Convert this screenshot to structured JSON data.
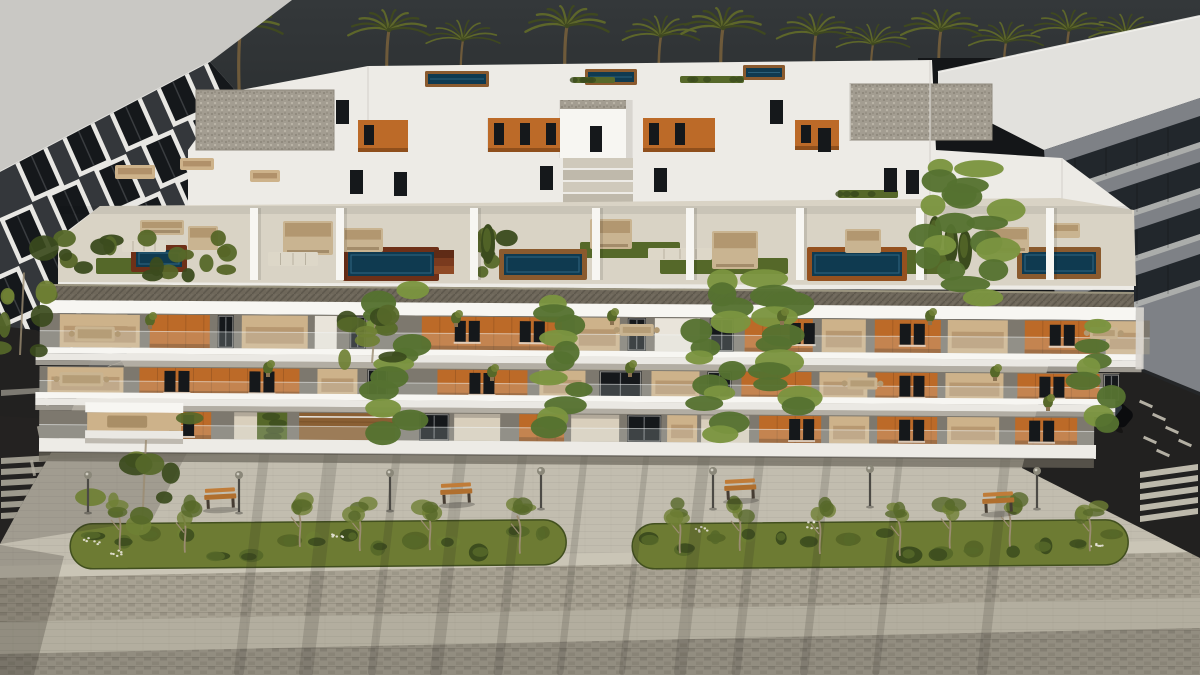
{
  "scene": {
    "label": "aerial-render-of-modern-apartment-complex-with-rooftop-pools-palms-and-promenade"
  },
  "colors": {
    "sky_top": "#34383a",
    "sky_bottom": "#1b1e20",
    "dark_gap": "#141618",
    "palm_frond": "#3f4820",
    "palm_frond_light": "#5d662a",
    "palm_trunk": "#6e5a3a",
    "left_roof": "#c9c8c4",
    "left_facade": "#34373b",
    "window_frame": "#e8e7e3",
    "window_glass": "#15181b",
    "right_roof": "#e2e1dd",
    "right_facade": "#7e8186",
    "right_glass": "#22272c",
    "right_slab": "#b0b1af",
    "white_mass": "#edebe6",
    "white_bright": "#f7f6f2",
    "white_shade": "#d8d5cf",
    "gravel": "#a39d91",
    "gravel_dot": "#8d877b",
    "gravel_light": "#bdb7aa",
    "terrace_floor": "#d9d3c5",
    "terrace_light": "#e6e1d4",
    "parapet": "#6e675a",
    "parapet_dark": "#4e483c",
    "parapet_light": "#9a947f",
    "pool_water": "#0f3a50",
    "pool_water_light": "#2b607a",
    "deck_mahogany": "#6e3018",
    "deck_brown": "#8a5a2e",
    "deck_terracotta": "#95511f",
    "deck_floor": "#8a5f33",
    "turf": "#556829",
    "hedge_dark": "#3b4b1d",
    "hedge_mid": "#566829",
    "hedge_light": "#6f8034",
    "orange_panel": "#bc6a28",
    "orange_dark": "#8f4f1c",
    "interior": "#cdb28a",
    "interior_dark": "#a5835c",
    "curtain": "#e9e4da",
    "entrance": "#d9cfbc",
    "recess_base": "#7d786e",
    "slab_face": "#eae8e3",
    "slab_shadow": "#b2ada3",
    "vine": "#557130",
    "vine_light": "#7b9440",
    "ground": "#b3ae9f",
    "sidewalk": "#c2bdaf",
    "cobble": "#a7a192",
    "cobble_dark": "#938d7f",
    "band_light": "#cac5b6",
    "band_bottom": "#a9a395",
    "grass": "#6d7b33",
    "grass_dark": "#566527",
    "tree_trunk": "#9b8c72",
    "bench_wood": "#b06f2e",
    "bench_wood_light": "#c07c38",
    "bench_dark": "#463d33",
    "lamp_pole": "#4c4a45",
    "lamp_head": "#8a8779",
    "road": "#222120",
    "road_mark": "#d8d3c4",
    "car_body": "#0b0c0e",
    "car_glass": "#2c343b",
    "shadow": "#2e2b25"
  },
  "palms": [
    [
      240,
      1,
      28,
      170
    ],
    [
      388,
      0.95,
      30,
      170
    ],
    [
      462,
      0.7,
      40,
      168
    ],
    [
      566,
      1,
      26,
      170
    ],
    [
      660,
      0.8,
      36,
      168
    ],
    [
      722,
      1,
      28,
      170
    ],
    [
      815,
      0.85,
      34,
      168
    ],
    [
      872,
      0.68,
      44,
      160
    ],
    [
      940,
      0.9,
      30,
      168
    ],
    [
      1005,
      0.72,
      42,
      160
    ],
    [
      1068,
      0.75,
      30,
      128
    ],
    [
      1125,
      0.7,
      34,
      118
    ]
  ],
  "left_building": {
    "roof": "0,0 292,0 210,62 0,172",
    "facade": "0,172 210,62 262,120 268,178 120,362 0,404",
    "shadow": "0,404 122,362 128,374 0,420",
    "windows": {
      "ox": 16,
      "oy": 158,
      "cols": 6,
      "rows": 4,
      "dxc": 47,
      "dyc": -25,
      "dxr": -13,
      "dyr": 62,
      "w": 30,
      "h": 44,
      "rot": -24
    }
  },
  "right_building": {
    "gap": "918,58 1062,58 1062,340 918,340",
    "roof": "938,72 1200,16 1200,98 1044,150 938,96",
    "facade": "1044,150 1200,98 1200,396 1058,338",
    "band_y0": 168,
    "band_step": 46,
    "band_h": 26,
    "n": 4,
    "base_shadow": "1058,334 1200,392 1200,398 1058,340"
  },
  "penthouse": {
    "mass": "188,210 188,150 230,92 368,66 932,60 936,150 1062,158 1134,212 1134,290 58,288 58,238 100,206",
    "gravel_roofs": [
      [
        196,
        90,
        138,
        60
      ],
      [
        850,
        84,
        142,
        56
      ],
      [
        578,
        106,
        52,
        46
      ]
    ],
    "rear_pools": [
      [
        428,
        74,
        58,
        10
      ],
      [
        588,
        72,
        46,
        10
      ],
      [
        746,
        68,
        36,
        9
      ],
      [
        1046,
        212,
        58,
        12
      ]
    ],
    "orange_walls": [
      [
        358,
        120,
        50,
        32
      ],
      [
        488,
        118,
        80,
        34
      ],
      [
        643,
        118,
        72,
        34
      ],
      [
        795,
        120,
        44,
        30
      ]
    ],
    "hedges": [
      [
        573,
        77,
        42,
        6
      ],
      [
        680,
        76,
        64,
        7
      ],
      [
        838,
        190,
        60,
        8
      ]
    ],
    "stair": [
      560,
      100,
      72,
      58
    ],
    "steps": [
      563,
      158,
      70,
      48
    ],
    "furniture": [
      [
        115,
        165,
        40,
        14
      ],
      [
        180,
        158,
        34,
        12
      ],
      [
        250,
        170,
        30,
        12
      ]
    ],
    "window_slits": [
      [
        350,
        170
      ],
      [
        394,
        172
      ],
      [
        540,
        166
      ],
      [
        654,
        168
      ],
      [
        884,
        168
      ],
      [
        906,
        170
      ],
      [
        336,
        100
      ],
      [
        770,
        100
      ],
      [
        818,
        128
      ]
    ],
    "edges": [
      [
        368,
        66,
        368,
        134
      ],
      [
        930,
        60,
        930,
        204
      ],
      [
        560,
        100,
        560,
        158
      ],
      [
        632,
        100,
        632,
        158
      ],
      [
        488,
        118,
        488,
        152
      ],
      [
        850,
        84,
        850,
        140
      ],
      [
        1062,
        158,
        1062,
        204
      ]
    ]
  },
  "terrace": {
    "floor": "58,282 58,240 100,206 1060,198 1134,210 1136,286",
    "turf": [
      [
        96,
        258,
        66,
        16
      ],
      [
        580,
        242,
        100,
        16
      ],
      [
        660,
        258,
        128,
        16
      ],
      [
        906,
        250,
        44,
        24
      ]
    ],
    "walls": [
      250,
      336,
      470,
      592,
      686,
      796,
      916,
      1046
    ],
    "pools": [
      [
        136,
        250,
        46,
        17,
        "deck_mahogany"
      ],
      [
        348,
        252,
        86,
        24,
        "deck_mahogany"
      ],
      [
        504,
        254,
        78,
        21,
        "deck_brown"
      ],
      [
        812,
        252,
        90,
        24,
        "deck_terracotta"
      ],
      [
        1022,
        252,
        74,
        22,
        "deck_brown"
      ]
    ],
    "steps": [
      434,
      250,
      20,
      26
    ],
    "furniture": [
      [
        140,
        220,
        44,
        15
      ],
      [
        188,
        226,
        30,
        24
      ],
      [
        283,
        221,
        50,
        34
      ],
      [
        343,
        228,
        40,
        24
      ],
      [
        590,
        219,
        42,
        30
      ],
      [
        712,
        231,
        46,
        38
      ],
      [
        845,
        229,
        36,
        24
      ],
      [
        985,
        227,
        44,
        26
      ],
      [
        1048,
        223,
        32,
        15
      ]
    ],
    "loungers": [
      [
        122,
        240,
        44,
        12
      ],
      [
        268,
        252,
        50,
        14
      ],
      [
        648,
        248,
        64,
        12
      ]
    ],
    "hedge_runs": [
      [
        62,
        236,
        174,
        42
      ],
      [
        480,
        230,
        28,
        46
      ]
    ],
    "cypresses": [
      [
        488,
        230
      ],
      [
        935,
        222
      ],
      [
        951,
        230
      ],
      [
        965,
        236
      ]
    ],
    "parapet": "40,284 1134,292 1134,308 40,300"
  },
  "facade": {
    "rot": 0.38,
    "fascia": [
      40,
      300,
      1096,
      13
    ],
    "recessA": {
      "y": 313,
      "h": 34,
      "x2": 1150,
      "segs": [
        [
          60,
          80,
          "i"
        ],
        [
          150,
          60,
          "o"
        ],
        [
          218,
          16,
          "w"
        ],
        [
          242,
          66,
          "i"
        ],
        [
          315,
          22,
          "c"
        ],
        [
          350,
          16,
          "w"
        ],
        [
          422,
          140,
          "o"
        ],
        [
          575,
          45,
          "i"
        ],
        [
          628,
          18,
          "w"
        ],
        [
          655,
          45,
          "c"
        ],
        [
          710,
          24,
          "w"
        ],
        [
          745,
          68,
          "o"
        ],
        [
          822,
          44,
          "i"
        ],
        [
          875,
          66,
          "o"
        ],
        [
          948,
          60,
          "i"
        ],
        [
          1025,
          75,
          "o"
        ],
        [
          1106,
          38,
          "i"
        ]
      ]
    },
    "slabA": [
      36,
      347,
      1106
    ],
    "recessB": {
      "y": 366,
      "h": 28,
      "x2": 1120,
      "segs": [
        [
          48,
          76,
          "i"
        ],
        [
          140,
          160,
          "o"
        ],
        [
          318,
          40,
          "i"
        ],
        [
          368,
          20,
          "w"
        ],
        [
          438,
          90,
          "o"
        ],
        [
          540,
          46,
          "i"
        ],
        [
          600,
          42,
          "w"
        ],
        [
          652,
          48,
          "i"
        ],
        [
          708,
          24,
          "w"
        ],
        [
          742,
          70,
          "o"
        ],
        [
          820,
          48,
          "i"
        ],
        [
          876,
          62,
          "o"
        ],
        [
          946,
          58,
          "i"
        ],
        [
          1018,
          82,
          "o"
        ],
        [
          1104,
          16,
          "w"
        ]
      ]
    },
    "slabB": [
      36,
      392,
      1080
    ],
    "recessC": {
      "y": 410,
      "h": 28,
      "x2": 1095,
      "segs": [
        [
          150,
          62,
          "o"
        ],
        [
          235,
          23,
          "e"
        ],
        [
          258,
          30,
          "g"
        ],
        [
          300,
          96,
          "d"
        ],
        [
          420,
          30,
          "w"
        ],
        [
          455,
          46,
          "e"
        ],
        [
          520,
          45,
          "o"
        ],
        [
          572,
          48,
          "e"
        ],
        [
          628,
          34,
          "w"
        ],
        [
          668,
          30,
          "i"
        ],
        [
          702,
          48,
          "e"
        ],
        [
          760,
          62,
          "o"
        ],
        [
          830,
          40,
          "i"
        ],
        [
          878,
          60,
          "o"
        ],
        [
          948,
          52,
          "i"
        ],
        [
          1016,
          62,
          "o"
        ]
      ]
    },
    "base": [
      40,
      438,
      1057,
      14
    ],
    "box": [
      88,
      402,
      94
    ],
    "win_pairs": [
      [
        455,
        318
      ],
      [
        520,
        318
      ],
      [
        165,
        370
      ],
      [
        250,
        370
      ],
      [
        790,
        318
      ],
      [
        900,
        318
      ],
      [
        1050,
        318
      ],
      [
        470,
        370
      ],
      [
        900,
        370
      ],
      [
        1040,
        370
      ],
      [
        170,
        414
      ],
      [
        790,
        414
      ],
      [
        900,
        414
      ],
      [
        1030,
        414
      ]
    ],
    "tables": [
      [
        75,
        326,
        40,
        15
      ],
      [
        60,
        372,
        44,
        14
      ],
      [
        620,
        320,
        34,
        12
      ],
      [
        848,
        372,
        30,
        12
      ],
      [
        1090,
        320,
        28,
        12
      ]
    ]
  },
  "greenery": {
    "vines": [
      [
        378,
        292,
        40,
        138
      ],
      [
        545,
        300,
        40,
        130
      ],
      [
        694,
        282,
        42,
        150
      ],
      [
        760,
        282,
        48,
        128
      ],
      [
        922,
        168,
        38,
        104
      ],
      [
        962,
        172,
        46,
        122
      ],
      [
        1082,
        330,
        34,
        96
      ]
    ],
    "plants": [
      [
        268,
        368
      ],
      [
        456,
        318
      ],
      [
        492,
        372
      ],
      [
        612,
        316
      ],
      [
        630,
        368
      ],
      [
        782,
        316
      ],
      [
        930,
        316
      ],
      [
        995,
        372
      ],
      [
        1048,
        402
      ],
      [
        150,
        320
      ]
    ],
    "trees": [
      [
        20,
        300,
        56,
        110
      ],
      [
        142,
        470,
        110,
        120
      ],
      [
        372,
        330,
        56,
        66
      ]
    ]
  },
  "street": {
    "sidewalk": "0,460 1134,436 1200,452 1200,548 0,572",
    "medians": [
      [
        70,
        524,
        496,
        45
      ],
      [
        632,
        524,
        496,
        45
      ]
    ],
    "median_trees": [
      120,
      185,
      300,
      360,
      430,
      520,
      680,
      740,
      820,
      900,
      950,
      1010,
      1090
    ],
    "flowers": [
      [
        92,
        542
      ],
      [
        118,
        552
      ],
      [
        340,
        536
      ],
      [
        700,
        530
      ],
      [
        812,
        526
      ],
      [
        1098,
        548
      ]
    ],
    "benches": [
      [
        204,
        492
      ],
      [
        440,
        487
      ],
      [
        724,
        483
      ],
      [
        982,
        496
      ]
    ],
    "lamps": [
      [
        88,
        478
      ],
      [
        239,
        478
      ],
      [
        390,
        476
      ],
      [
        541,
        474
      ],
      [
        713,
        474
      ],
      [
        870,
        472
      ],
      [
        1037,
        474
      ]
    ],
    "light_strip": "0,566 1200,540 1200,552 0,578",
    "cobble_band": "0,578 1200,552 1200,598 0,622",
    "bottom_band": "0,654 1200,628 1200,675 0,675"
  },
  "roads": {
    "left": {
      "poly": "0,326 36,330 92,358 64,430 24,500 0,544",
      "cw_y": [
        458,
        469,
        480,
        491,
        502,
        513
      ],
      "cw_x": 54,
      "dashes": [
        [
          46,
          398
        ],
        [
          40,
          434
        ],
        [
          33,
          468
        ]
      ]
    },
    "right": {
      "poly": "1056,336 1200,396 1200,558 1022,468",
      "cw_y": [
        468,
        479,
        490,
        501,
        512
      ],
      "dashes": [
        [
          1146,
          404
        ],
        [
          1159,
          417
        ],
        [
          1172,
          430
        ],
        [
          1185,
          443
        ],
        [
          1150,
          440
        ],
        [
          1163,
          453
        ]
      ],
      "car": [
        1112,
        408
      ]
    }
  },
  "shadows": {
    "streaks": [
      [
        265,
        448
      ],
      [
        332,
        446
      ],
      [
        398,
        444
      ],
      [
        462,
        444
      ],
      [
        524,
        443
      ],
      [
        586,
        442
      ],
      [
        648,
        442
      ],
      [
        706,
        440
      ],
      [
        762,
        440
      ],
      [
        830,
        438
      ],
      [
        902,
        437
      ],
      [
        1008,
        436
      ]
    ],
    "widths": [
      10,
      14,
      8,
      12,
      9,
      7,
      6,
      12,
      9,
      8,
      7,
      10
    ],
    "corner": "0,545 64,556 34,675 0,675"
  }
}
